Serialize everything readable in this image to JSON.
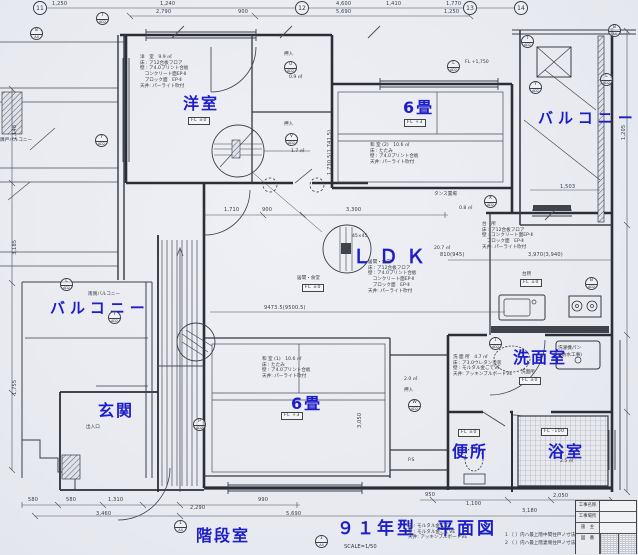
{
  "sheet": {
    "title": "９１年型　平面図",
    "scale": "SCALE=1/50"
  },
  "room_labels": {
    "yoshitsu": "洋室",
    "washitsu2": "6畳",
    "balcony_right": "バルコニー",
    "balcony_left": "バルコニー",
    "ldk": "ＬＤＫ",
    "genkan": "玄関",
    "washitsu1": "6畳",
    "senmenshitsu": "洗面室",
    "benjo": "便所",
    "yokushitsu": "浴室",
    "kaidanshitsu": "階段室"
  },
  "fl": {
    "yoshitsu": "FL ±0",
    "washitsu2": "FL +3",
    "ldk": "FL ±0",
    "washitsu1": "FL +3",
    "kitchen": "FL ±0",
    "senmen": "FL ±0",
    "benjo": "FL ±0",
    "bath": "FL -100",
    "balcony_note": "FL +1,750"
  },
  "notes": {
    "yoshitsu": "洋　室　9.9 ㎡\n床 : ア12合板フロア\n壁 : ア4.0プリント合板\n　コンクリート面EP-Ⅱ\n　ブロック面　EP-Ⅱ\n天井: パーライト吹付",
    "washitsu2": "和 室 (2)　10.6 ㎡\n床 : たたみ\n壁 : ア4.0プリント合板\n天井: パーライト吹付",
    "washitsu1": "和 室 (1)　10.6 ㎡\n床 : たたみ\n壁 : ア4.0プリント合板\n天井: パーライト吹付",
    "ldk": "居間・食堂\n床 : ア12合板フロア\n壁 : ア4.0プリント合板\n　コンクリート面EP-Ⅱ\n　ブロック面　EP-Ⅱ\n天井: パーライト吹付",
    "kitchen": "台　所\n床 : ア12合板フロア\n壁 : コンクリート面EP-Ⅱ\n　ブロック面　EP-Ⅱ\n天井: パーライト吹付",
    "senmen": "洗 面 所　4.7 ㎡\n床 : ア3.0ウレタン塗装\n壁 : モルタル金ごてVE\n天井: アッキンブルボードVE",
    "stair_spec": "床 : モルタル金ごて\n壁 : モルタル金ごてVE\n天井: アッキンブルボードVE"
  },
  "legend": {
    "l1": "1 〔 〕内ハ最上階中間住戸ノ寸法ヲ示ス。",
    "l2": "2 〈 〉内ハ最上階妻側住戸ノ寸法ヲ示ス。"
  },
  "small": {
    "oshiire": "押入",
    "tansu": "タンス置場",
    "ps": "P.S",
    "minami": "南側バルコニー",
    "rinko": "隣戸バルコニー",
    "sentaku1": "洗濯機パン",
    "sentaku2": "(防水工事)",
    "deiri": "出入口",
    "daidokoro": "台所",
    "ima": "居間・食堂",
    "senmen_s": "洗面所",
    "note4545": "45×45"
  },
  "areas": {
    "u": "0.9 ㎡",
    "v": "1.7 ㎡",
    "tansu": "0.8 ㎡",
    "ldk": "20.7 ㎡",
    "w": "2.0 ㎡",
    "bath": "2.5 ㎡"
  },
  "dims": {
    "top": {
      "a1": "1,250",
      "a2": "1,240",
      "a3": "4,600",
      "a4": "1,410",
      "a5": "1,770",
      "b1": "2,790",
      "b2": "900",
      "b3": "5,690",
      "b4": "1,250"
    },
    "bottom": {
      "a1": "580",
      "a2": "580",
      "a3": "1,310",
      "a4": "990",
      "a5": "2,290",
      "a6": "3,460",
      "a7": "5,690",
      "a8": "950",
      "a9": "1,100",
      "a10": "3,180",
      "a11": "2,050"
    },
    "inner": {
      "i1": "1,710",
      "i2": "900",
      "i3": "3,300",
      "i4": "9473.5(9500.5)",
      "i5": "810(945)",
      "i6": "3,970(3,940)",
      "i7": "1,503",
      "i8": "1,730.5(1,741.5)",
      "i9": "3,050",
      "i10": "1,148",
      "i11": "3,185",
      "i12": "1,755",
      "i13": "1,205"
    }
  },
  "symbols": {
    "u": "U",
    "v": "V",
    "w": "W",
    "x": "X",
    "t": "T",
    "p": "P",
    "i1": "I",
    "i2": "I",
    "l1": "L",
    "l2": "L",
    "l3": "L",
    "y1": "Y",
    "y2": "Y",
    "y3": "Y",
    "b1": "B",
    "b2": "B",
    "n8": "8",
    "s1": "1",
    "c1": "1",
    "ad": "AD2",
    "a4": "A4",
    "g11": "11",
    "g12": "12",
    "g13": "13",
    "g14": "14"
  },
  "title_block": {
    "r1": "工事名称",
    "r2": "工事場所",
    "r3": "施　主",
    "r4": "図　番"
  }
}
